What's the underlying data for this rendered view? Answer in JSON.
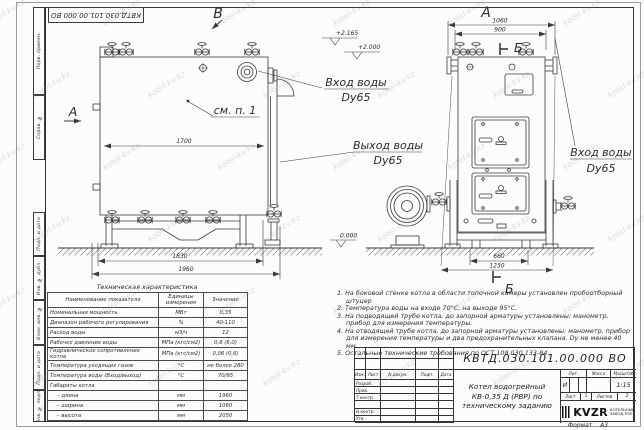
{
  "watermark": {
    "text": "kotel-kv.kz"
  },
  "frame": {
    "top_stamp": "КВТД.030.101.00.000  ВО",
    "left_fields": [
      "Перв. примен.",
      "Справ. №",
      "Подп. и дата",
      "Инв. № дубл.",
      "Взам. инв. №",
      "Подп. и дата",
      "Инв. № подл."
    ],
    "format_label": "Формат",
    "format_value": "А3"
  },
  "drawing": {
    "view_b": "В",
    "view_a": "А",
    "section_a": "А",
    "section_b_top": "Б",
    "section_b_bottom": "Б",
    "see_note": "см. п. 1",
    "inlet_left": {
      "line1": "Вход воды",
      "line2": "Dy65"
    },
    "outlet": {
      "line1": "Выход воды",
      "line2": "Dy65"
    },
    "inlet_right": {
      "line1": "Вход воды",
      "line2": "Dy65"
    },
    "elevations": {
      "top1": "+2.165",
      "top2": "+2.000",
      "zero": "0.000"
    },
    "dims": {
      "d1700": "1700",
      "d1830": "1830",
      "d1960": "1960",
      "d1060": "1060",
      "d900": "900",
      "d660": "660",
      "d1230": "1230"
    }
  },
  "spec_table": {
    "caption": "Техническая характеристика",
    "col1": "Наименование показателя",
    "col2": "Единицы измерения",
    "col3": "Значение",
    "rows": [
      {
        "name": "Номинальная мощность",
        "unit": "МВт",
        "value": "0,35"
      },
      {
        "name": "Диапазон рабочего регулирования",
        "unit": "%",
        "value": "40-110"
      },
      {
        "name": "Расход воды",
        "unit": "м3/ч",
        "value": "12"
      },
      {
        "name": "Рабочее давление воды",
        "unit": "МПа (кгс/см2)",
        "value": "0,6 (6,0)"
      },
      {
        "name": "Гидравлическое сопротивление котла",
        "unit": "МПа (кгс/см2)",
        "value": "0,06 (0,6)"
      },
      {
        "name": "Температура уходящих газов",
        "unit": "°С",
        "value": "не более 280"
      },
      {
        "name": "Температура воды (Вход/выход)",
        "unit": "°С",
        "value": "70/95"
      },
      {
        "name": "Габариты котла",
        "unit": "",
        "value": ""
      },
      {
        "name": "– длина",
        "unit": "мм",
        "value": "1960"
      },
      {
        "name": "– ширина",
        "unit": "мм",
        "value": "1060"
      },
      {
        "name": "– высота",
        "unit": "мм",
        "value": "2050"
      }
    ]
  },
  "notes": {
    "items": [
      "1.  На боковой стенке котла в области топочной камеры установлен пробоотборный штуцер",
      "2.  Температура воды на входе 70°С, на выходе 95°С.",
      "3.  На подводящей трубе котла, до запорной арматуры установлены: манометр, прибор для измерения температуры.",
      "4.  На отводящей трубе котла, до запорной арматуры установлены: манометр, прибор для измерения температуры и два предохранительных клапана. Dу не менее 40 мм.",
      "5.  Остальные технические требования по ОСТ 108.030.133-84."
    ]
  },
  "title_block": {
    "doc_number": "КВТД.030.101.00.000  ВО",
    "col_izm": "Изм.",
    "col_list": "Лист",
    "col_doc": "N докум.",
    "col_sign": "Подп.",
    "col_date": "Дата",
    "row_labels": [
      "Разраб.",
      "Пров.",
      "Т.контр.",
      "",
      "Н.контр.",
      "Утв."
    ],
    "product_title": "Котел водогрейный КВ-0,35 Д (РВР) по техническому заданию",
    "lit_header": "Лит.",
    "mass_header": "Масса",
    "scale_header": "Масштаб",
    "lit_value": "И",
    "scale_value": "1:15",
    "sheet_label": "Лист",
    "sheet_number": "1",
    "sheets_label": "Листов",
    "sheets_total": "2",
    "logo": "KVZR",
    "logo_sub": [
      "КОТЕЛЬНЫЙ",
      "ЗАВОД РЭП"
    ]
  }
}
